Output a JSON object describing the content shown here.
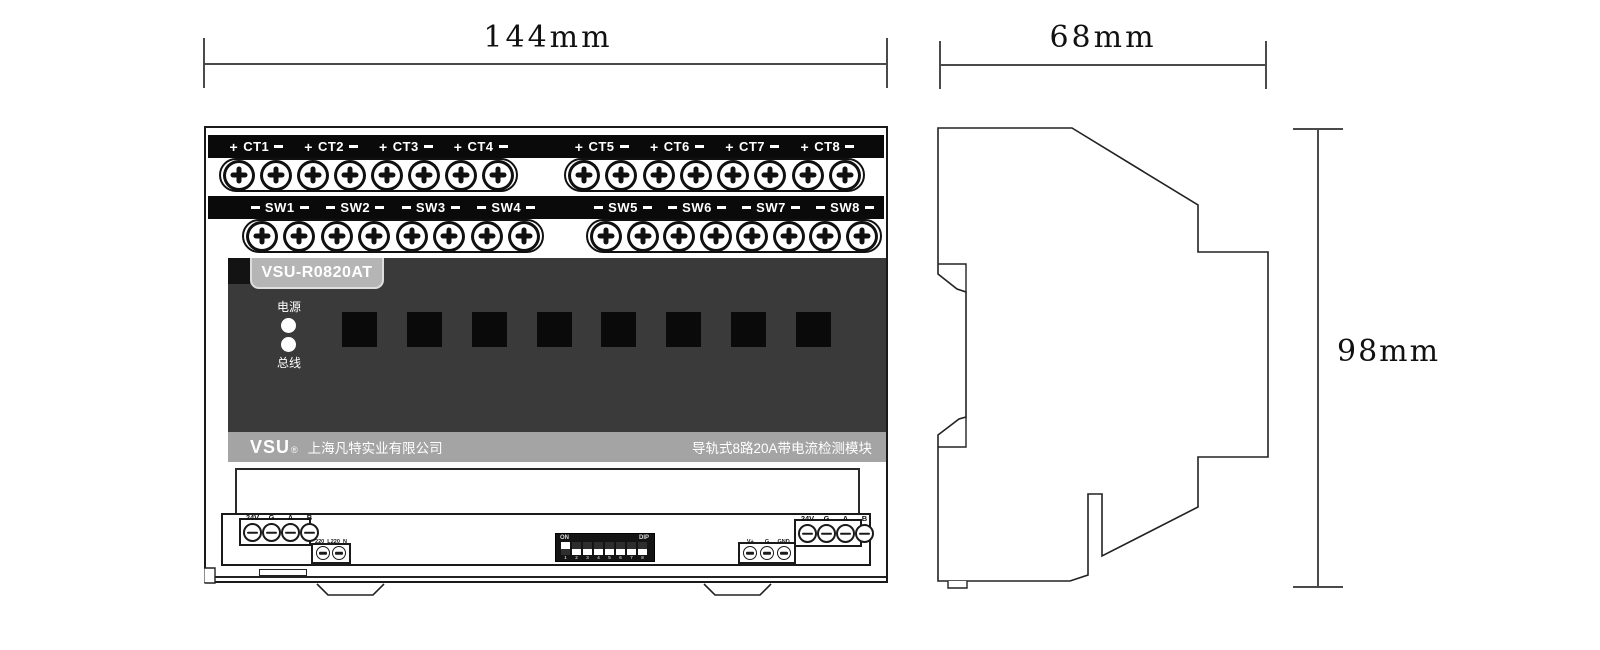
{
  "dimensions": {
    "front_width": "144mm",
    "side_width": "68mm",
    "height": "98mm"
  },
  "front": {
    "ct": {
      "sign_plus": "+",
      "sign_minus": "−",
      "channels": [
        "CT1",
        "CT2",
        "CT3",
        "CT4",
        "CT5",
        "CT6",
        "CT7",
        "CT8"
      ]
    },
    "sw": {
      "sign": "−",
      "channels": [
        "SW1",
        "SW2",
        "SW3",
        "SW4",
        "SW5",
        "SW6",
        "SW7",
        "SW8"
      ]
    },
    "model": "VSU-R0820AT",
    "leds": {
      "power": "电源",
      "bus": "总线"
    },
    "displays": 8,
    "brand": {
      "logo": "VSU",
      "reg": "®",
      "company": "上海凡特实业有限公司",
      "product": "导轨式8路20A带电流检测模块"
    },
    "terminals": {
      "power_left": [
        "24V",
        "G",
        "A",
        "B"
      ],
      "ac": [
        "220_L",
        "220_N"
      ],
      "dip": {
        "on": "ON",
        "label": "DIP",
        "numbers": [
          "1",
          "2",
          "3",
          "4",
          "5",
          "6",
          "7",
          "8"
        ],
        "states": [
          1,
          0,
          0,
          0,
          0,
          0,
          0,
          0
        ]
      },
      "aux": [
        "V+",
        "G",
        "GND"
      ],
      "power_right": [
        "24V",
        "G",
        "A",
        "B"
      ]
    }
  },
  "colors": {
    "panel": "#3a3a3a",
    "bar": "#0a0a0a",
    "brand_bar": "#a4a4a4",
    "model_tab": "#b5b5b5",
    "line": "#1a1a1a"
  }
}
